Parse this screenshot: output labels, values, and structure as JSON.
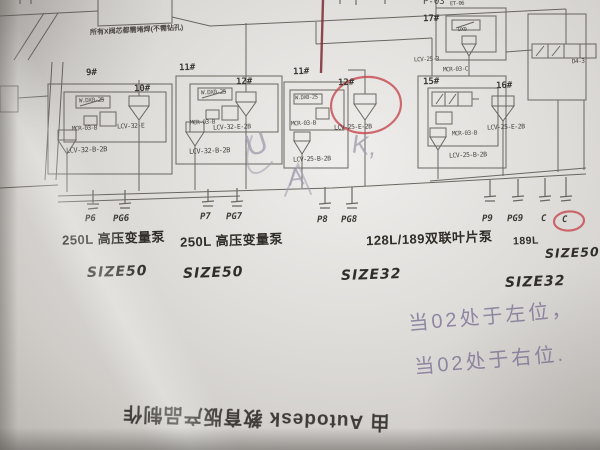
{
  "photo": {
    "red_accent": "#c8474d",
    "dark_red_pen": "#7e2733",
    "pencil_color": "#83789a",
    "paper_color": "#e0dedb"
  },
  "diagram": {
    "top_note": "所有X阀芯都需堵焊(不需钻孔)",
    "top_right_port": "P-03",
    "stations": [
      {
        "id": "9#",
        "pilot": "W.DX0-25",
        "mid": "MCR-03-B",
        "bottom": "LCV-32-B-2B"
      },
      {
        "id": "10#",
        "bottom": "LCV-32-E"
      },
      {
        "id": "11#",
        "pilot": "W.DX0-25",
        "mid": "MCR-03-B",
        "bottom": "LCV-32-B-2B"
      },
      {
        "id": "12#",
        "bottom": "LCV-32-E-2B"
      },
      {
        "id": "11#",
        "pilot": "W.DX0-25",
        "mid": "MCR-03-B",
        "bottom": "LCV-25-B-2B"
      },
      {
        "id": "12#",
        "bottom": "LCV-25-E-2B",
        "circled": true
      },
      {
        "id": "15#",
        "pilot": "MCR-03-C",
        "mid": "MCR-03-B",
        "bottom": "LCV-25-B-2B"
      },
      {
        "id": "16#",
        "bottom": "LCV-25-E-2B"
      },
      {
        "id": "17#",
        "pilot": "ET-06",
        "mid": "DX0",
        "bottom": "LCV-25-3"
      }
    ],
    "right_valve_label": "D4-3",
    "ports": [
      "P6",
      "PG6",
      "P7",
      "PG7",
      "P8",
      "PG8",
      "P9",
      "PG9",
      "C",
      "C"
    ],
    "circled_port": "C",
    "pumps": {
      "pump1": "250L 高压变量泵",
      "pump2": "250L 高压变量泵",
      "pump3": "128L/189双联叶片泵",
      "pump4": "189L",
      "size1": "SIZE50",
      "size2": "SIZE50",
      "size3": "SIZE32",
      "size4": "SIZE32",
      "size5": "SIZE50"
    },
    "handwriting": {
      "line1": "当02处于左位，",
      "line2": "当02处于右位.",
      "scribble1": "U",
      "scribble2": "K,",
      "scribble3": "A"
    },
    "watermark": "由 Autodesk 教育版产品制作"
  }
}
